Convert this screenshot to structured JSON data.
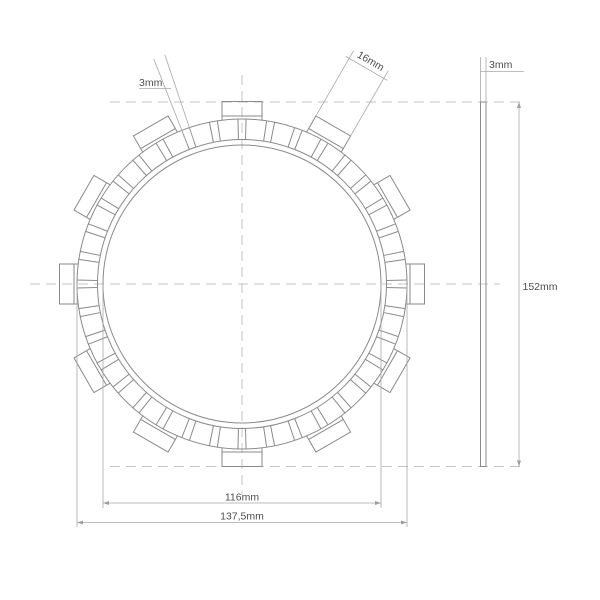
{
  "drawing": {
    "canvas": {
      "width": 600,
      "height": 600,
      "background": "#ffffff"
    },
    "colors": {
      "part_line": "#8a8a8a",
      "dimension_line": "#a8a8a8",
      "centerline": "#c4c4c4",
      "text": "#4d4d4d"
    },
    "front_view": {
      "cx": 242,
      "cy": 284,
      "circles": {
        "inner_r": 139,
        "pad_inner_r": 144.5,
        "outer_r": 165
      },
      "tabs": {
        "count": 12,
        "step_deg": 30,
        "start_deg": 0,
        "width_px": 40,
        "base_r": 163.5,
        "outer_r": 182.5,
        "shoulder_r": 168
      },
      "slots": {
        "count": 36,
        "step_deg": 10,
        "half_angle_deg": 1.4,
        "inner_r": 144.5,
        "outer_r": 165
      },
      "centerline_h": {
        "x1": 30,
        "x2": 500,
        "y": 284
      },
      "centerline_v": {
        "x": 242,
        "y1": 75,
        "y2": 495
      }
    },
    "side_view": {
      "x": 480.5,
      "width": 5.5,
      "y1": 102,
      "y2": 466.5
    },
    "projection_lines": {
      "top": {
        "y": 102,
        "x1": 110,
        "x2": 523
      },
      "bottom": {
        "y": 466.5,
        "x1": 110,
        "x2": 523
      }
    },
    "dimensions": {
      "slot_width": {
        "label": "3mm",
        "angle_deg": 110,
        "half_angle_deg": 1.4,
        "r1": 150,
        "r2": 242,
        "label_x": 139,
        "label_y": 86,
        "underline": {
          "x1": 139,
          "x2": 171,
          "y": 88.5
        }
      },
      "tab_width": {
        "label": "16mm",
        "angle_deg": 60,
        "half_width": 20,
        "r1": 182.5,
        "r2": 258,
        "cross_r": 249,
        "cross_half": 24,
        "label_r": 254,
        "label_rot_deg": 30
      },
      "thickness": {
        "label": "3mm",
        "line_y": 71.5,
        "line_x1": 480.5,
        "line_x2": 524,
        "ext_top_y": 57,
        "label_x": 489,
        "label_y": 68
      },
      "overall_height": {
        "label": "152mm",
        "x": 519,
        "y1": 102,
        "y2": 466.5,
        "label_x": 522.5,
        "label_y": 290
      },
      "inner_diameter": {
        "label": "116mm",
        "y": 503,
        "x1": 103,
        "x2": 381,
        "ext_y1": 284,
        "ext_y2": 508,
        "label_y": 500.5
      },
      "outer_diameter": {
        "label": "137,5mm",
        "y": 522.5,
        "x1": 77,
        "x2": 407,
        "ext_y1": 284,
        "ext_y2": 527,
        "label_y": 519.5
      }
    }
  }
}
